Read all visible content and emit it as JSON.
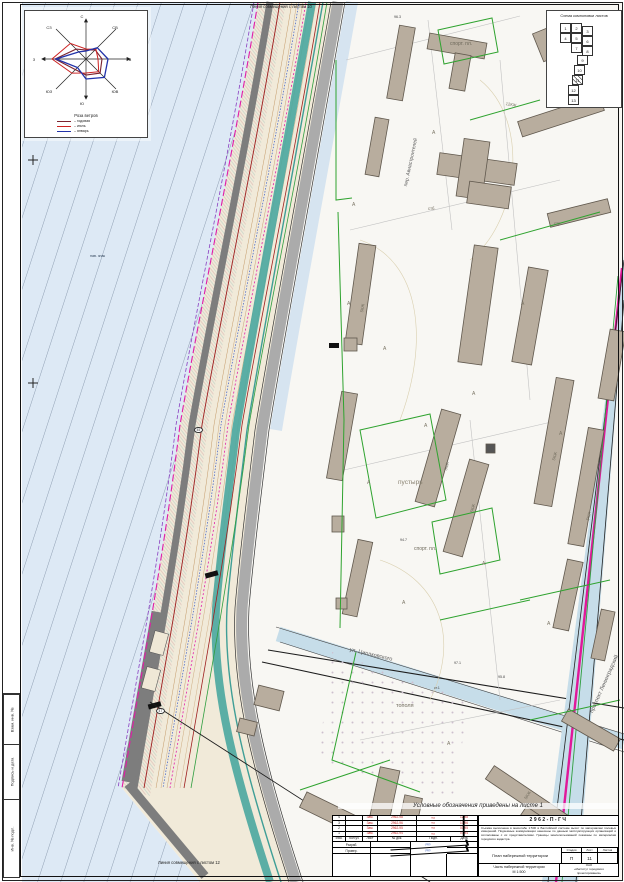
{
  "frame": {
    "matchline_top": "Линия совмещения с листом 10",
    "matchline_bottom": "Линия совмещения с листом 12",
    "side_labels": [
      "Взам. инв. №",
      "Подпись и дата",
      "Инв. № подл."
    ]
  },
  "wind_rose": {
    "title": "Роза ветров",
    "directions": [
      {
        "t": "С",
        "x": 57,
        "y": 3
      },
      {
        "t": "СВ",
        "x": 90,
        "y": 14
      },
      {
        "t": "В",
        "x": 105,
        "y": 46
      },
      {
        "t": "ЮВ",
        "x": 90,
        "y": 78
      },
      {
        "t": "Ю",
        "x": 57,
        "y": 90
      },
      {
        "t": "ЮЗ",
        "x": 24,
        "y": 78
      },
      {
        "t": "З",
        "x": 9,
        "y": 46
      },
      {
        "t": "СЗ",
        "x": 24,
        "y": 14
      }
    ],
    "legend": [
      {
        "label": "годовая",
        "color": "#7b2430"
      },
      {
        "label": "июль",
        "color": "#cc2222"
      },
      {
        "label": "январь",
        "color": "#2233aa"
      }
    ]
  },
  "layout_scheme": {
    "title": "Схема компоновки листов",
    "current_sheet": "11",
    "cells": [
      {
        "n": "1",
        "x": 13,
        "y": 12
      },
      {
        "n": "2",
        "x": 24,
        "y": 12
      },
      {
        "n": "3",
        "x": 35,
        "y": 15
      },
      {
        "n": "4",
        "x": 13,
        "y": 22
      },
      {
        "n": "5",
        "x": 24,
        "y": 22
      },
      {
        "n": "6",
        "x": 35,
        "y": 25
      },
      {
        "n": "7",
        "x": 24,
        "y": 32
      },
      {
        "n": "8",
        "x": 35,
        "y": 35
      },
      {
        "n": "9",
        "x": 30,
        "y": 44
      },
      {
        "n": "10",
        "x": 27,
        "y": 54
      },
      {
        "n": "11",
        "x": 25,
        "y": 64,
        "hatched": true
      },
      {
        "n": "12",
        "x": 21,
        "y": 74
      },
      {
        "n": "13",
        "x": 21,
        "y": 84
      }
    ]
  },
  "map": {
    "labels": [
      {
        "t": "Линия совмещения с листом 10",
        "x": 250,
        "y": 5,
        "s": 4.2,
        "c": "#222"
      },
      {
        "t": "Линия совмещения с листом 12",
        "x": 158,
        "y": 861,
        "s": 4.2,
        "c": "#222"
      },
      {
        "t": "нав. знак",
        "x": 90,
        "y": 255,
        "s": 3.6,
        "c": "#33455c"
      },
      {
        "t": "пустырь",
        "x": 398,
        "y": 480,
        "s": 6.5,
        "c": "#8a8372"
      },
      {
        "t": "спорт. пл.",
        "x": 450,
        "y": 42,
        "s": 5,
        "c": "#6f6a5c"
      },
      {
        "t": "спорт. пл.",
        "x": 414,
        "y": 547,
        "s": 5,
        "c": "#6f6a5c"
      },
      {
        "t": "тополя",
        "x": 396,
        "y": 704,
        "s": 5.5,
        "c": "#6f6a5c"
      },
      {
        "t": "дет. пл.",
        "x": 347,
        "y": 855,
        "s": 4.5,
        "c": "#555555"
      },
      {
        "t": "пер. Авиастроителей",
        "x": 404,
        "y": 186,
        "r": -78,
        "s": 5,
        "c": "#5a5a5a"
      },
      {
        "t": "ул. Циолковского",
        "x": 350,
        "y": 648,
        "r": 13,
        "s": 5.5,
        "c": "#5a5a5a"
      },
      {
        "t": "проспект Ленинградский",
        "x": 590,
        "y": 712,
        "r": -66,
        "s": 5.5,
        "c": "#5a5a5a"
      },
      {
        "t": "стб.",
        "x": 428,
        "y": 207,
        "s": 4.2,
        "c": "#6f6a5c"
      },
      {
        "t": "стр.",
        "x": 554,
        "y": 222,
        "s": 4.2,
        "c": "#6f6a5c"
      },
      {
        "t": "5КЖ",
        "x": 444,
        "y": 470,
        "r": -75,
        "s": 4.2,
        "c": "#6f6a5c"
      },
      {
        "t": "5КЖ",
        "x": 470,
        "y": 512,
        "r": -75,
        "s": 4.2,
        "c": "#6f6a5c"
      },
      {
        "t": "5КЖ",
        "x": 552,
        "y": 460,
        "r": -75,
        "s": 4.2,
        "c": "#6f6a5c"
      },
      {
        "t": "5КЖ",
        "x": 586,
        "y": 520,
        "r": -75,
        "s": 4.2,
        "c": "#6f6a5c"
      },
      {
        "t": "5КЖ",
        "x": 360,
        "y": 312,
        "r": -80,
        "s": 4.2,
        "c": "#6f6a5c"
      },
      {
        "t": "5КЖ",
        "x": 524,
        "y": 798,
        "r": -58,
        "s": 4.2,
        "c": "#6f6a5c"
      },
      {
        "t": "12КЖ",
        "x": 506,
        "y": 102,
        "r": 10,
        "s": 4.2,
        "c": "#6f6a5c"
      },
      {
        "t": "96.3",
        "x": 394,
        "y": 16,
        "s": 3.6,
        "c": "#444444"
      },
      {
        "t": "95.8",
        "x": 498,
        "y": 676,
        "s": 3.6,
        "c": "#444444"
      },
      {
        "t": "94.7",
        "x": 400,
        "y": 539,
        "s": 3.6,
        "c": "#444444"
      },
      {
        "t": "97.7",
        "x": 350,
        "y": 844,
        "s": 3.6,
        "c": "#444444"
      },
      {
        "t": "97.1",
        "x": 454,
        "y": 662,
        "s": 3.6,
        "c": "#444444"
      },
      {
        "t": "ст.1",
        "x": 434,
        "y": 687,
        "s": 3.4,
        "c": "#444444"
      },
      {
        "t": "А",
        "x": 347,
        "y": 302,
        "s": 5,
        "c": "#7c7666"
      },
      {
        "t": "А",
        "x": 383,
        "y": 347,
        "s": 5,
        "c": "#7c7666"
      },
      {
        "t": "А",
        "x": 424,
        "y": 424,
        "s": 5,
        "c": "#7c7666"
      },
      {
        "t": "А",
        "x": 367,
        "y": 481,
        "s": 5,
        "c": "#7c7666"
      },
      {
        "t": "А",
        "x": 472,
        "y": 392,
        "s": 5,
        "c": "#7c7666"
      },
      {
        "t": "А",
        "x": 521,
        "y": 302,
        "s": 5,
        "c": "#7c7666"
      },
      {
        "t": "А",
        "x": 559,
        "y": 432,
        "s": 5,
        "c": "#7c7666"
      },
      {
        "t": "А",
        "x": 402,
        "y": 601,
        "s": 5,
        "c": "#7c7666"
      },
      {
        "t": "А",
        "x": 482,
        "y": 562,
        "s": 5,
        "c": "#7c7666"
      },
      {
        "t": "А",
        "x": 547,
        "y": 622,
        "s": 5,
        "c": "#7c7666"
      },
      {
        "t": "А",
        "x": 432,
        "y": 131,
        "s": 5,
        "c": "#7c7666"
      },
      {
        "t": "А",
        "x": 352,
        "y": 203,
        "s": 5,
        "c": "#7c7666"
      },
      {
        "t": "А",
        "x": 447,
        "y": 742,
        "s": 5,
        "c": "#7c7666"
      },
      {
        "t": "А",
        "x": 508,
        "y": 842,
        "s": 5,
        "c": "#7c7666"
      },
      {
        "t": "45",
        "x": 194,
        "y": 427,
        "s": 3.4,
        "c": "#333333",
        "circled": true
      },
      {
        "t": "47",
        "x": 156,
        "y": 708,
        "s": 3.4,
        "c": "#333333",
        "circled": true
      }
    ]
  },
  "stamp": {
    "note": "Условные обозначения приведены на листе 1",
    "doc_code": "2962-П-ГЧ",
    "description": "Съёмка выполнена в масштабе 1:500 в Балтийской системе высот по материалам полевых измерений. Подземные коммуникации нанесены по данным эксплуатирующих организаций и согласованы с их представителями. Границы землепользований показаны по материалам городского кадастра.",
    "revision_header": [
      "Изм.",
      "Кол.уч",
      "Лист",
      "№ док.",
      "Подп.",
      "Дата"
    ],
    "revision_rows": [
      [
        "4",
        "",
        "Зам.",
        "2962-98",
        "≈",
        "12.98"
      ],
      [
        "3",
        "",
        "Зам.",
        "2962-96",
        "≈",
        "10.96"
      ],
      [
        "2",
        "",
        "Зам.",
        "2962-95",
        "≈",
        "03.95"
      ],
      [
        "1",
        "",
        "Зам.",
        "2962-94",
        "≈",
        "07.94"
      ]
    ],
    "role_rows": [
      [
        "Разраб.",
        "",
        "≈",
        ""
      ],
      [
        "Провер.",
        "",
        "≈",
        ""
      ]
    ],
    "title_main": "План набережной территории",
    "stage_label": "Стадия",
    "sheet_label": "Лист",
    "sheets_label": "Листов",
    "stage": "П",
    "sheet_no": "11",
    "sheets_total": "",
    "title_sub": "Часть набережной территории\nМ 1:500",
    "org": "ОАО\n«Институт городского\nпроектирования»"
  }
}
